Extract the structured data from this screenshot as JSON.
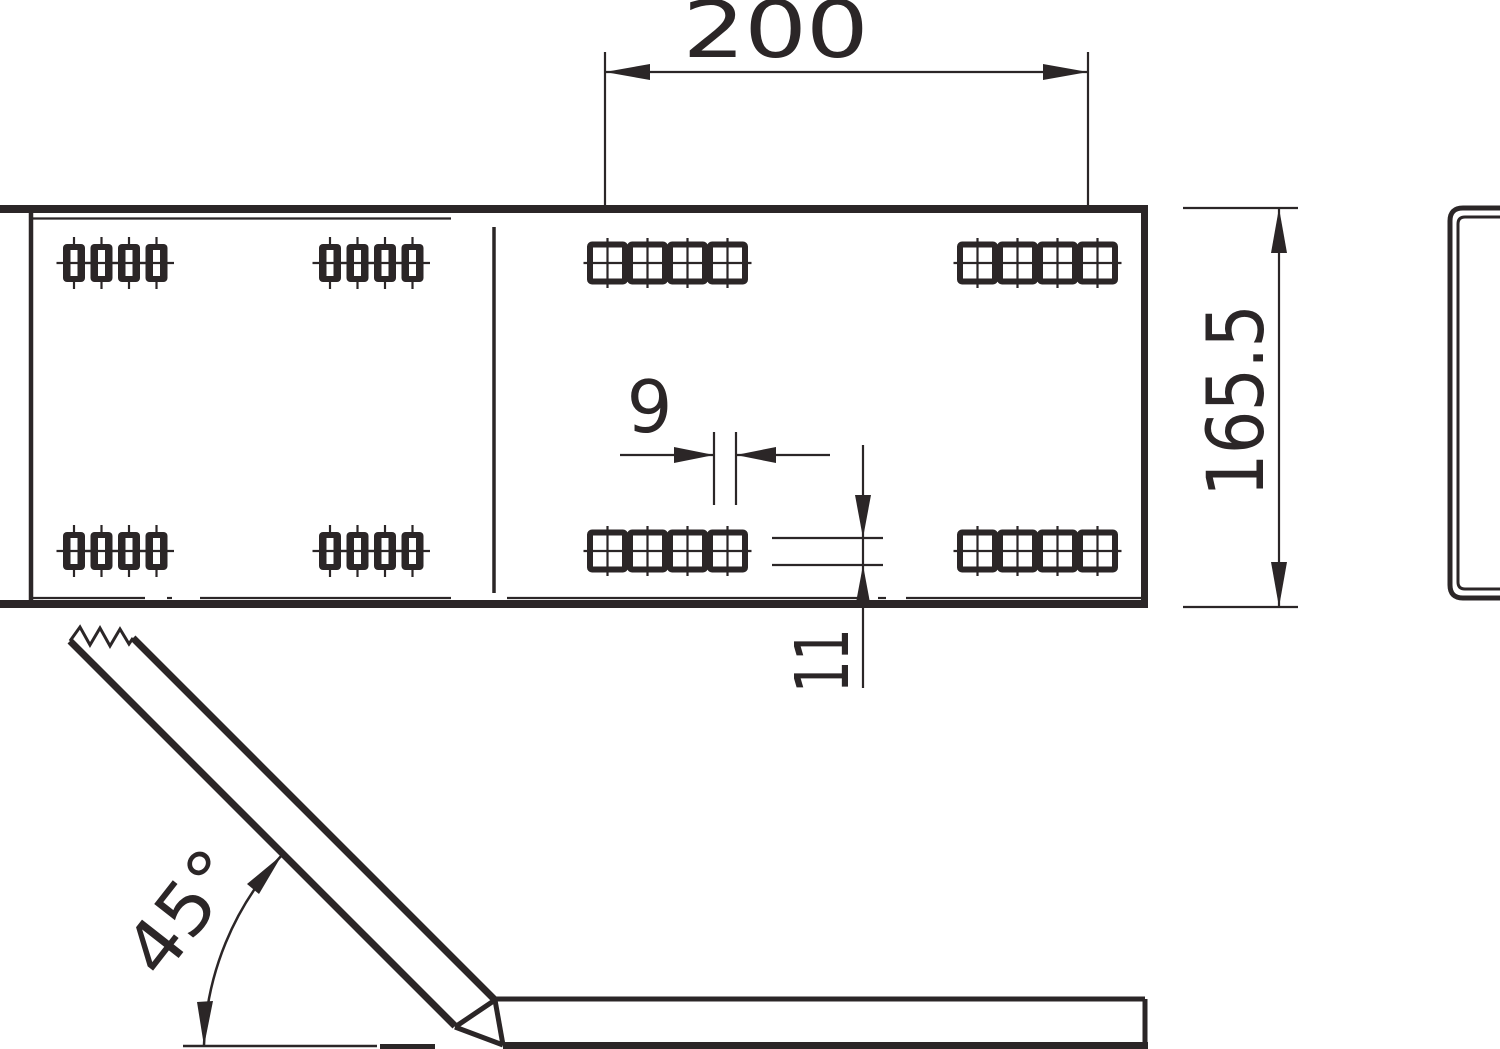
{
  "colors": {
    "ink": "#2b2627",
    "paper": "#ffffff"
  },
  "drawing": {
    "dimensions": {
      "length": "200",
      "height": "165.5",
      "slot_width": "9",
      "slot_height": "11",
      "bend_angle": "45°"
    },
    "holes": {
      "rows_per_view": 2,
      "oblong_slot_groups_per_row": 2,
      "square_slot_groups_per_row": 2,
      "holes_per_group": 4
    }
  }
}
